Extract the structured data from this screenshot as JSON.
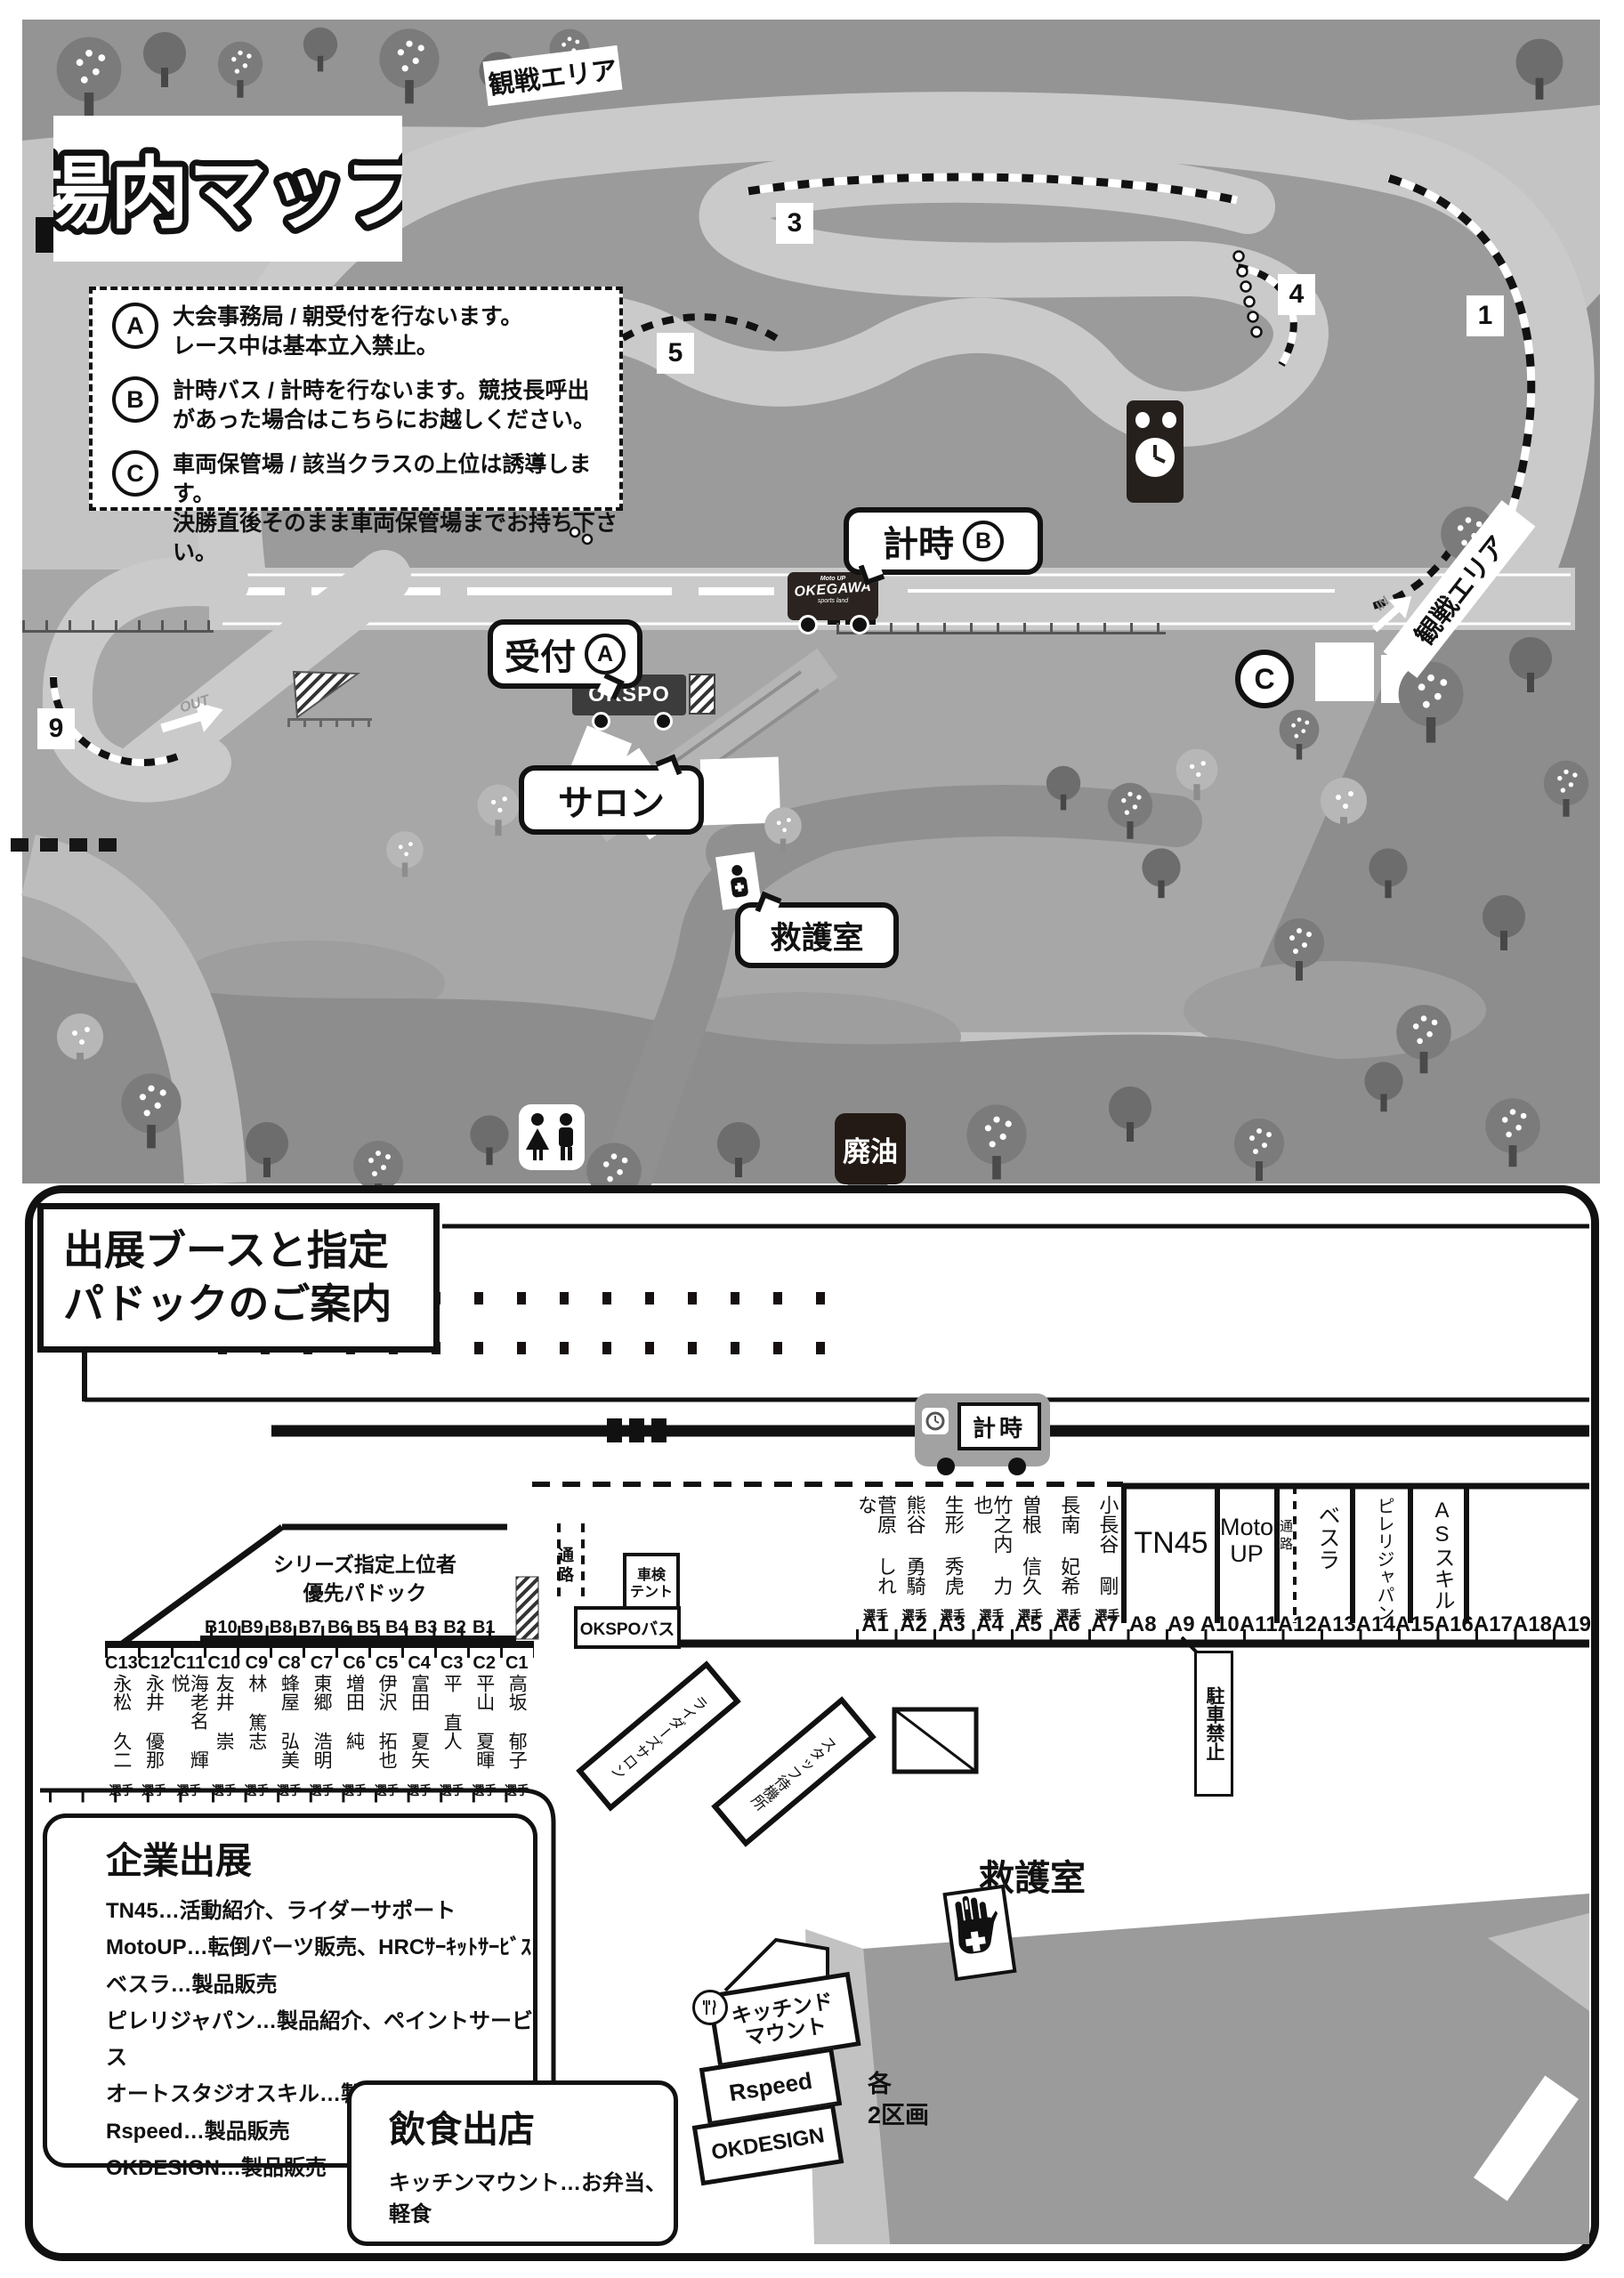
{
  "map": {
    "title": "場内マップ",
    "spectator_area_top": "観戦エリア",
    "spectator_area_right": "観戦エリア",
    "legend": [
      {
        "key": "A",
        "line1": "大会事務局 / 朝受付を行ないます。",
        "line2": "レース中は基本立入禁止。"
      },
      {
        "key": "B",
        "line1": "計時バス / 計時を行ないます。競技長呼出",
        "line2": "があった場合はこちらにお越しください。"
      },
      {
        "key": "C",
        "line1": "車両保管場 / 該当クラスの上位は誘導します。",
        "line2": "決勝直後そのまま車両保管場までお持ち下さい。"
      }
    ],
    "corners": {
      "c1": "1",
      "c3": "3",
      "c4": "4",
      "c5": "5",
      "c9": "9"
    },
    "callouts": {
      "timing": "計時",
      "timing_key": "B",
      "reception": "受付",
      "reception_key": "A",
      "salon": "サロン",
      "first_aid": "救護室"
    },
    "markers": {
      "c_point": "C",
      "waste_oil": "廃油",
      "in": "IN",
      "out": "OUT"
    },
    "buses": {
      "okegawa": "OKEGAWA",
      "okegawa_sub": "sports land",
      "okegawa_moto": "Moto UP",
      "okspo": "OKSPO"
    }
  },
  "guide": {
    "title_line1": "出展ブースと指定",
    "title_line2": "パドックのご案内",
    "timing_bus": "計時",
    "priority_line1": "シリーズ指定上位者",
    "priority_line2": "優先パドック",
    "corridor": "通路",
    "inspection_tent_line1": "車検",
    "inspection_tent_line2": "テント",
    "okspo_bus": "OKSPOバス",
    "no_parking": "駐車禁止",
    "riders_salon": "ライダーズサロン",
    "staff_area": "スタッフ待機所",
    "first_aid": "救護室",
    "plots_line1": "各",
    "plots_line2": "2区画",
    "a_labels": [
      "A1",
      "A2",
      "A3",
      "A4",
      "A5",
      "A6",
      "A7",
      "A8",
      "A9",
      "A10",
      "A11",
      "A12",
      "A13",
      "A14",
      "A15",
      "A16",
      "A17",
      "A18",
      "A19"
    ],
    "a_riders": [
      {
        "name": "菅原 しれな",
        "tag": "選手"
      },
      {
        "name": "熊谷 勇騎",
        "tag": "選手"
      },
      {
        "name": "生形 秀虎",
        "tag": "選手"
      },
      {
        "name": "竹之内 力也",
        "tag": "選手"
      },
      {
        "name": "曽根 信久",
        "tag": "選手"
      },
      {
        "name": "長南 妃希",
        "tag": "選手"
      },
      {
        "name": "小長谷 剛",
        "tag": "選手"
      }
    ],
    "vendors": {
      "tn45": "TN45",
      "motoup_line1": "Moto",
      "motoup_line2": "UP",
      "vesrah": "ベスラ",
      "pirelli": "ピレリジャパン",
      "asskill": "ASスキル"
    },
    "b_labels": [
      "B10",
      "B9",
      "B8",
      "B7",
      "B6",
      "B5",
      "B4",
      "B3",
      "B2",
      "B1"
    ],
    "c_riders": [
      {
        "id": "C13",
        "name": "永松 久二",
        "tag": "選手"
      },
      {
        "id": "C12",
        "name": "永井 優那",
        "tag": "選手"
      },
      {
        "id": "C11",
        "name": "海老名 輝悦",
        "tag": "選手"
      },
      {
        "id": "C10",
        "name": "友井 崇",
        "tag": "選手"
      },
      {
        "id": "C9",
        "name": "林 篤志",
        "tag": "選手"
      },
      {
        "id": "C8",
        "name": "蜂屋 弘美",
        "tag": "選手"
      },
      {
        "id": "C7",
        "name": "東郷 浩明",
        "tag": "選手"
      },
      {
        "id": "C6",
        "name": "増田 純",
        "tag": "選手"
      },
      {
        "id": "C5",
        "name": "伊沢 拓也",
        "tag": "選手"
      },
      {
        "id": "C4",
        "name": "富田 夏矢",
        "tag": "選手"
      },
      {
        "id": "C3",
        "name": "平 直人",
        "tag": "選手"
      },
      {
        "id": "C2",
        "name": "平山 夏暉",
        "tag": "選手"
      },
      {
        "id": "C1",
        "name": "高坂 郁子",
        "tag": "選手"
      }
    ],
    "exhibitors_panel": {
      "title": "企業出展",
      "items": [
        "TN45…活動紹介、ライダーサポート",
        "MotoUP…転倒パーツ販売、HRCｻｰｷｯﾄｻｰﾋﾞｽ",
        "ベスラ…製品販売",
        "ピレリジャパン…製品紹介、ペイントサービス",
        "オートスタジオスキル…製品販売",
        "Rspeed…製品販売",
        "OKDESIGN…製品販売"
      ]
    },
    "food_panel": {
      "title": "飲食出店",
      "item": "キッチンマウント…お弁当、軽食"
    },
    "food_booths": {
      "kitchen_line1": "キッチンド",
      "kitchen_line2": "マウント",
      "rspeed": "Rspeed",
      "okdesign": "OKDESIGN"
    }
  },
  "colors": {
    "ink": "#111111",
    "track": "#cacaca",
    "infield": "#9b9b9b",
    "paddock": "#a7a7a7",
    "forest": "#8d8d8d",
    "dark_badge": "#231a15"
  }
}
